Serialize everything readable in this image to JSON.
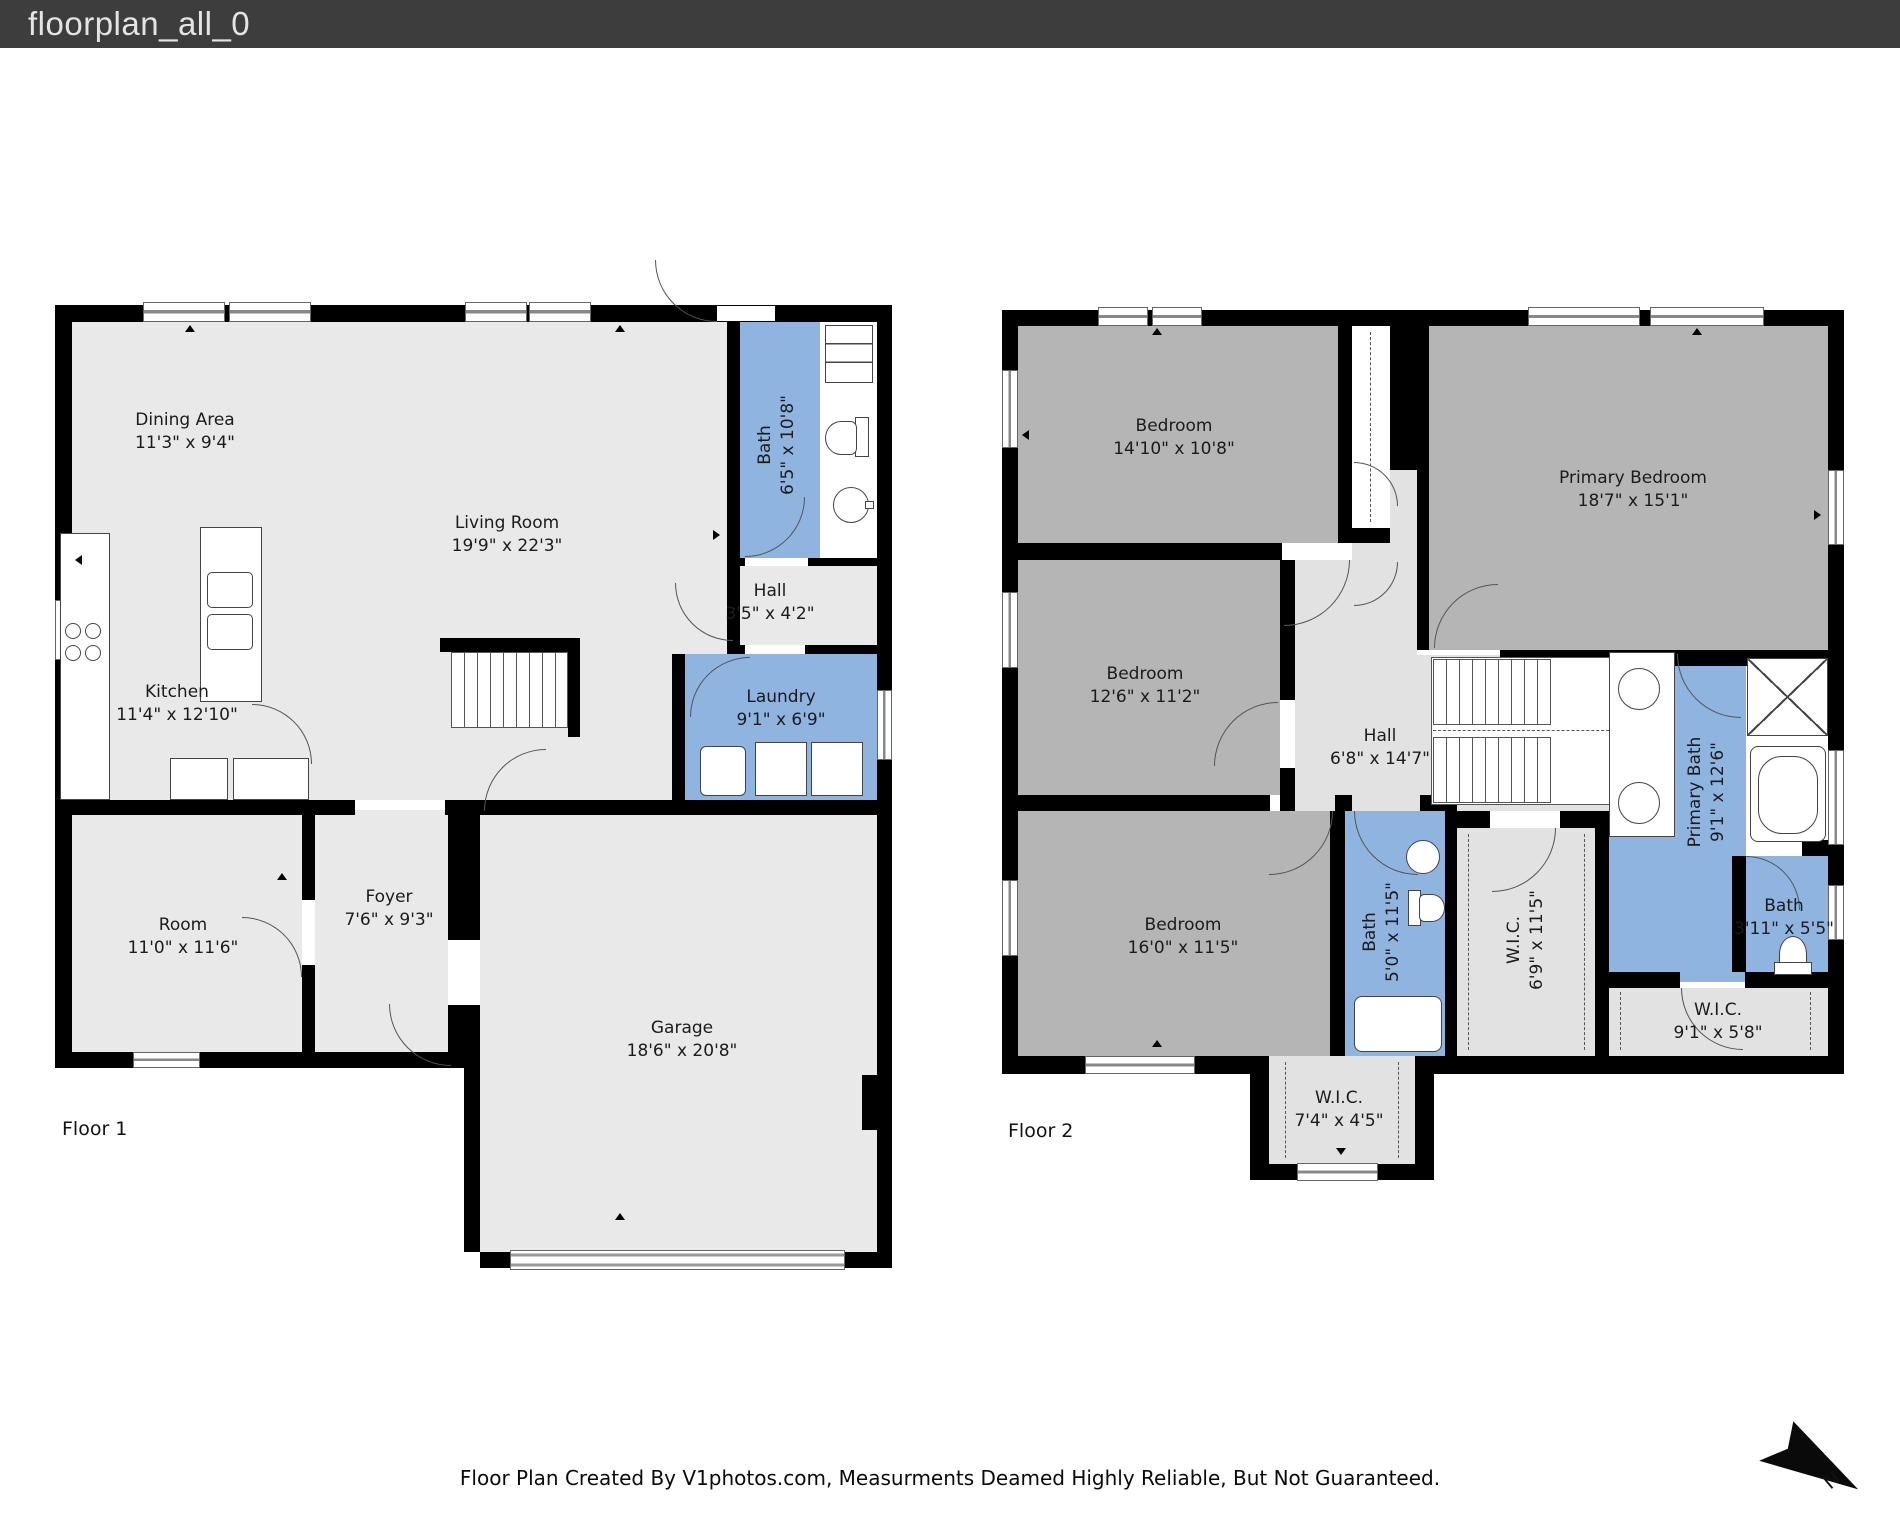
{
  "title_bar": {
    "title": "floorplan_all_0"
  },
  "floor1": {
    "label": "Floor 1",
    "rooms": [
      {
        "name": "Dining Area",
        "dims": "11'3\" x 9'4\""
      },
      {
        "name": "Living Room",
        "dims": "19'9\" x 22'3\""
      },
      {
        "name": "Bath",
        "dims": "6'5\" x 10'8\""
      },
      {
        "name": "Hall",
        "dims": "3'5\" x 4'2\""
      },
      {
        "name": "Kitchen",
        "dims": "11'4\" x 12'10\""
      },
      {
        "name": "Laundry",
        "dims": "9'1\" x 6'9\""
      },
      {
        "name": "Room",
        "dims": "11'0\" x 11'6\""
      },
      {
        "name": "Foyer",
        "dims": "7'6\" x 9'3\""
      },
      {
        "name": "Garage",
        "dims": "18'6\" x 20'8\""
      }
    ]
  },
  "floor2": {
    "label": "Floor 2",
    "rooms": [
      {
        "name": "Bedroom",
        "dims": "14'10\" x 10'8\""
      },
      {
        "name": "Primary Bedroom",
        "dims": "18'7\" x 15'1\""
      },
      {
        "name": "Bedroom",
        "dims": "12'6\" x 11'2\""
      },
      {
        "name": "Hall",
        "dims": "6'8\" x 14'7\""
      },
      {
        "name": "Bedroom",
        "dims": "16'0\" x 11'5\""
      },
      {
        "name": "Bath",
        "dims": "5'0\" x 11'5\""
      },
      {
        "name": "W.I.C.",
        "dims": "6'9\" x 11'5\""
      },
      {
        "name": "Primary Bath",
        "dims": "9'1\" x 12'6\""
      },
      {
        "name": "Bath",
        "dims": "3'11\" x 5'5\""
      },
      {
        "name": "W.I.C.",
        "dims": "9'1\" x 5'8\""
      },
      {
        "name": "W.I.C.",
        "dims": "7'4\" x 4'5\""
      }
    ]
  },
  "footer": {
    "disclaimer": "Floor Plan Created By V1photos.com, Measurments Deamed Highly Reliable, But Not Guaranteed."
  },
  "compass": {
    "label": "N"
  },
  "colors": {
    "wall": "#000000",
    "bath_blue": "#8fb4e0",
    "bedroom_gray": "#b5b5b5",
    "room_light": "#e9e9e9",
    "titlebar_bg": "#3d3d3d",
    "titlebar_text": "#e4e4e4"
  }
}
